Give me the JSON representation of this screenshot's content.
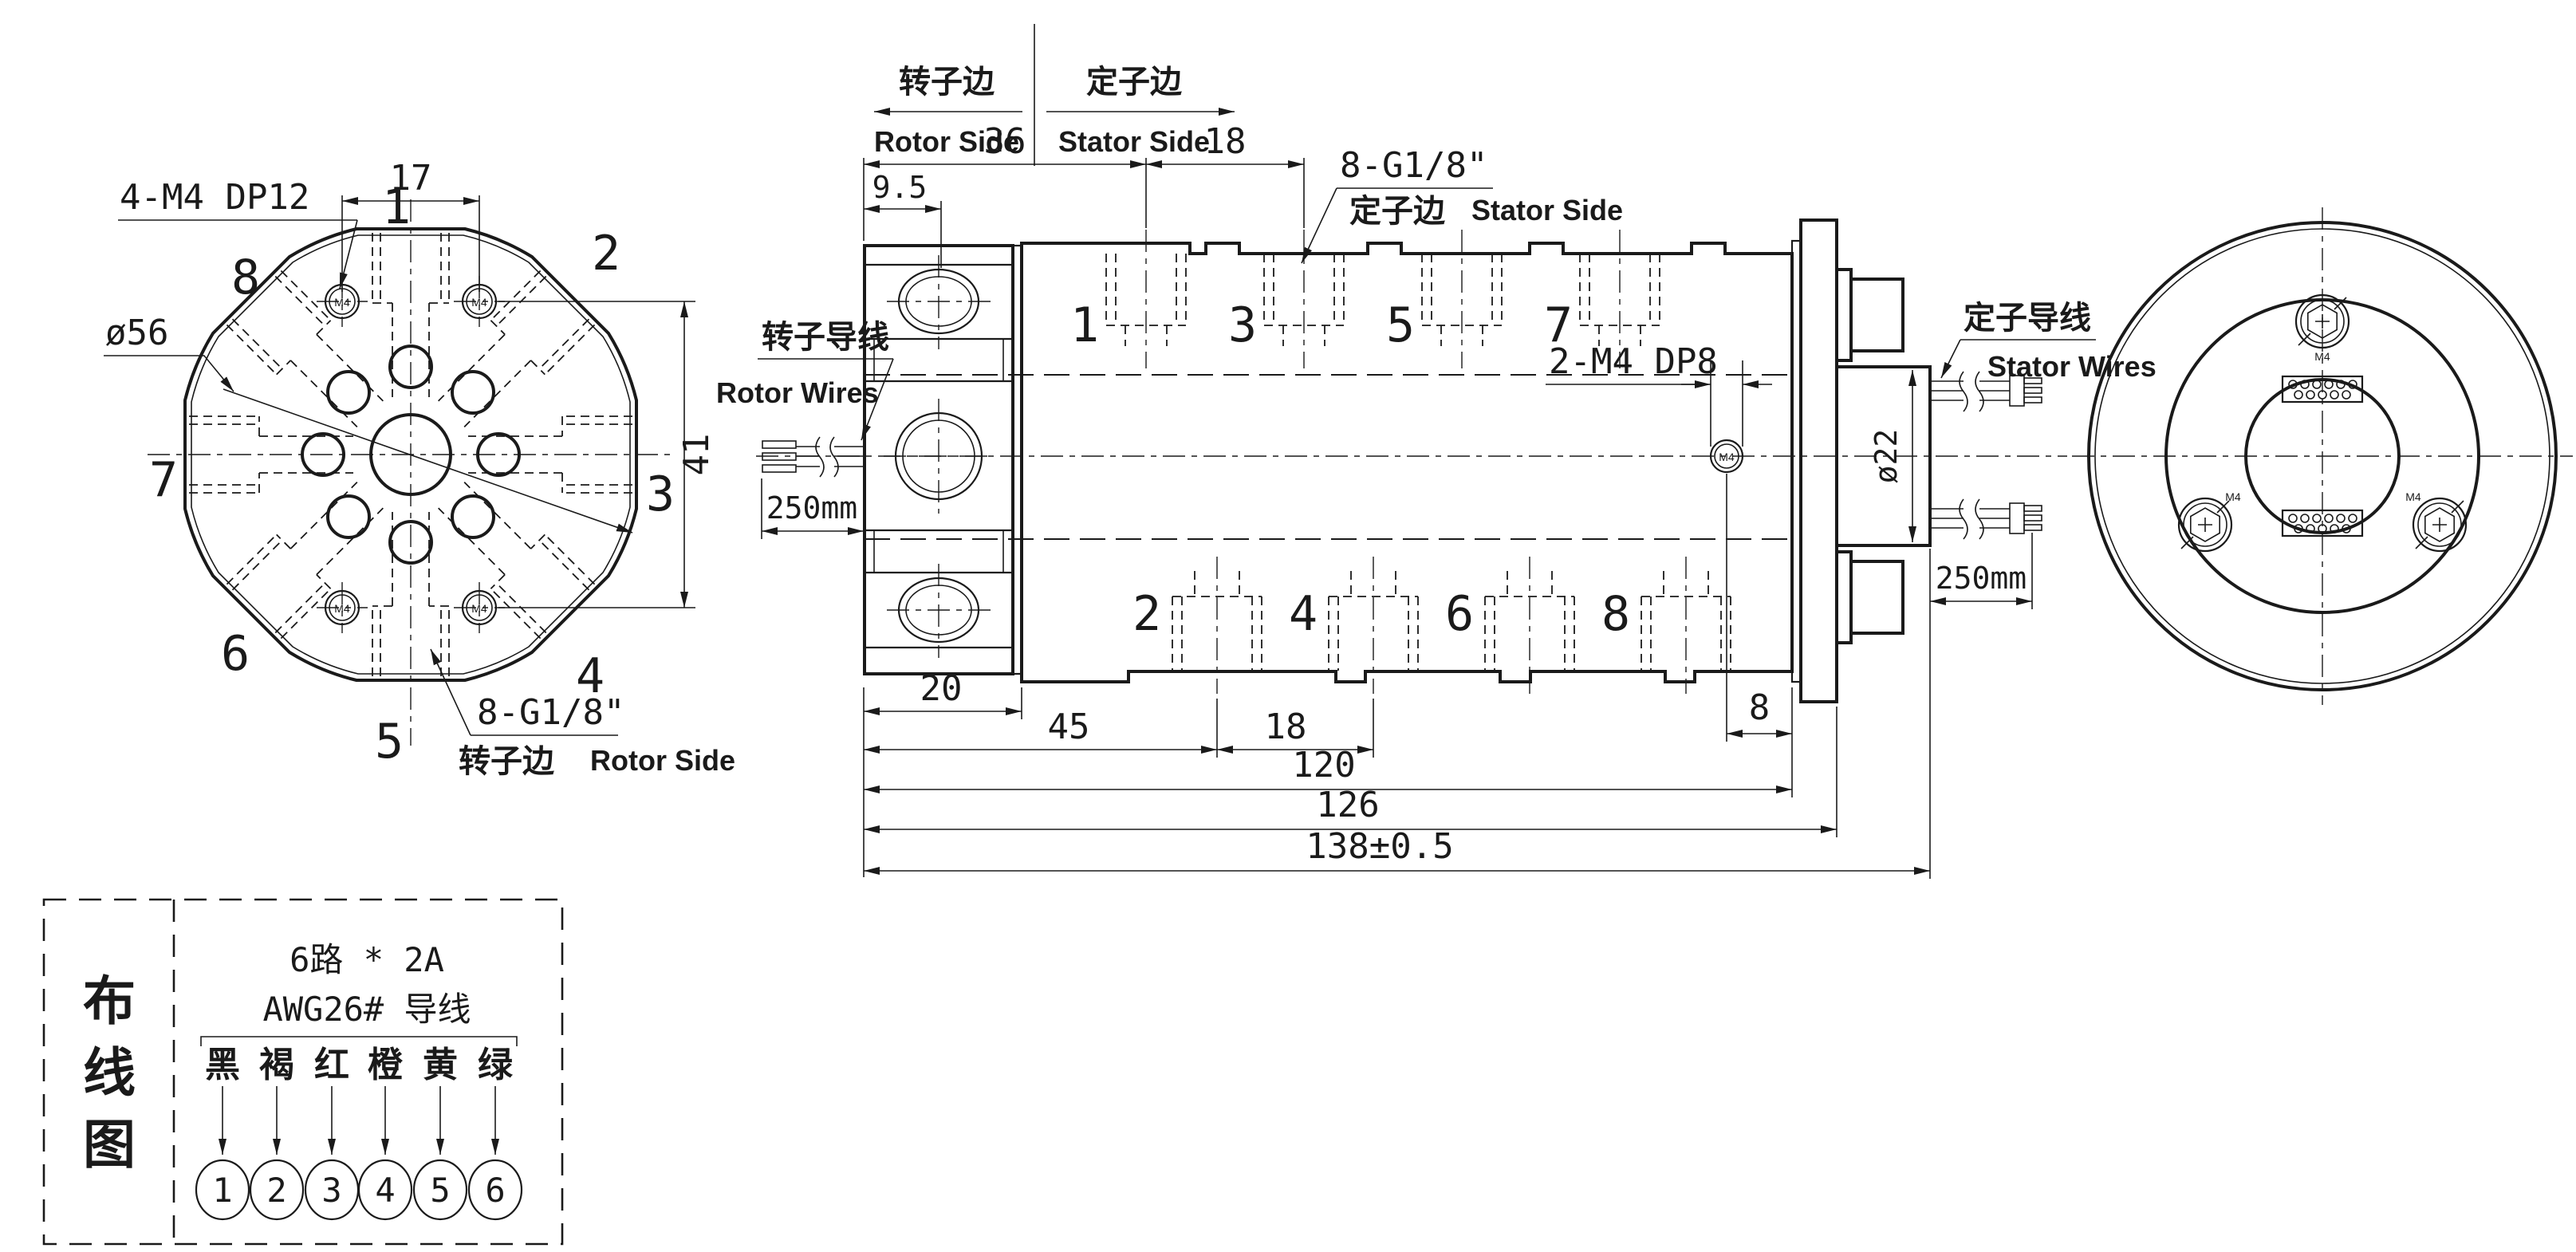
{
  "drawing_title": "slip-ring rotary union drawing",
  "hdr": {
    "rotor_cn": "转子边",
    "rotor_en": "Rotor Side",
    "stator_cn": "定子边",
    "stator_en": "Stator Side"
  },
  "lv": {
    "d17": "17",
    "d41": "41",
    "dia56": "ø56",
    "m4note": "4-M4 DP12",
    "g18": "8-G1/8\"",
    "side_cn": "转子边",
    "side_en": "Rotor Side",
    "m4": "M4",
    "ports": [
      "1",
      "2",
      "3",
      "4",
      "5",
      "6",
      "7",
      "8"
    ]
  },
  "sv": {
    "d36": "36",
    "d18a": "18",
    "d95": "9.5",
    "d20": "20",
    "d45": "45",
    "d18b": "18",
    "d8": "8",
    "d120": "120",
    "d126": "126",
    "d138": "138±0.5",
    "dia22": "ø22",
    "lead_rotor": "250mm",
    "lead_stator": "250mm",
    "m4note": "2-M4 DP8",
    "m4": "M4",
    "g18": "8-G1/8\"",
    "stator_cn": "定子边",
    "stator_en": "Stator Side",
    "rw_cn": "转子导线",
    "rw_en": "Rotor Wires",
    "sw_cn": "定子导线",
    "sw_en": "Stator Wires",
    "top_ports": [
      "1",
      "3",
      "5",
      "7"
    ],
    "bottom_ports": [
      "2",
      "4",
      "6",
      "8"
    ]
  },
  "rv": {
    "m4": "M4"
  },
  "wd": {
    "title": [
      "布",
      "线",
      "图"
    ],
    "spec1": "6路 * 2A",
    "spec2": "AWG26# 导线",
    "colors": [
      "黑",
      "褐",
      "红",
      "橙",
      "黄",
      "绿"
    ],
    "numbers": [
      "1",
      "2",
      "3",
      "4",
      "5",
      "6"
    ]
  }
}
